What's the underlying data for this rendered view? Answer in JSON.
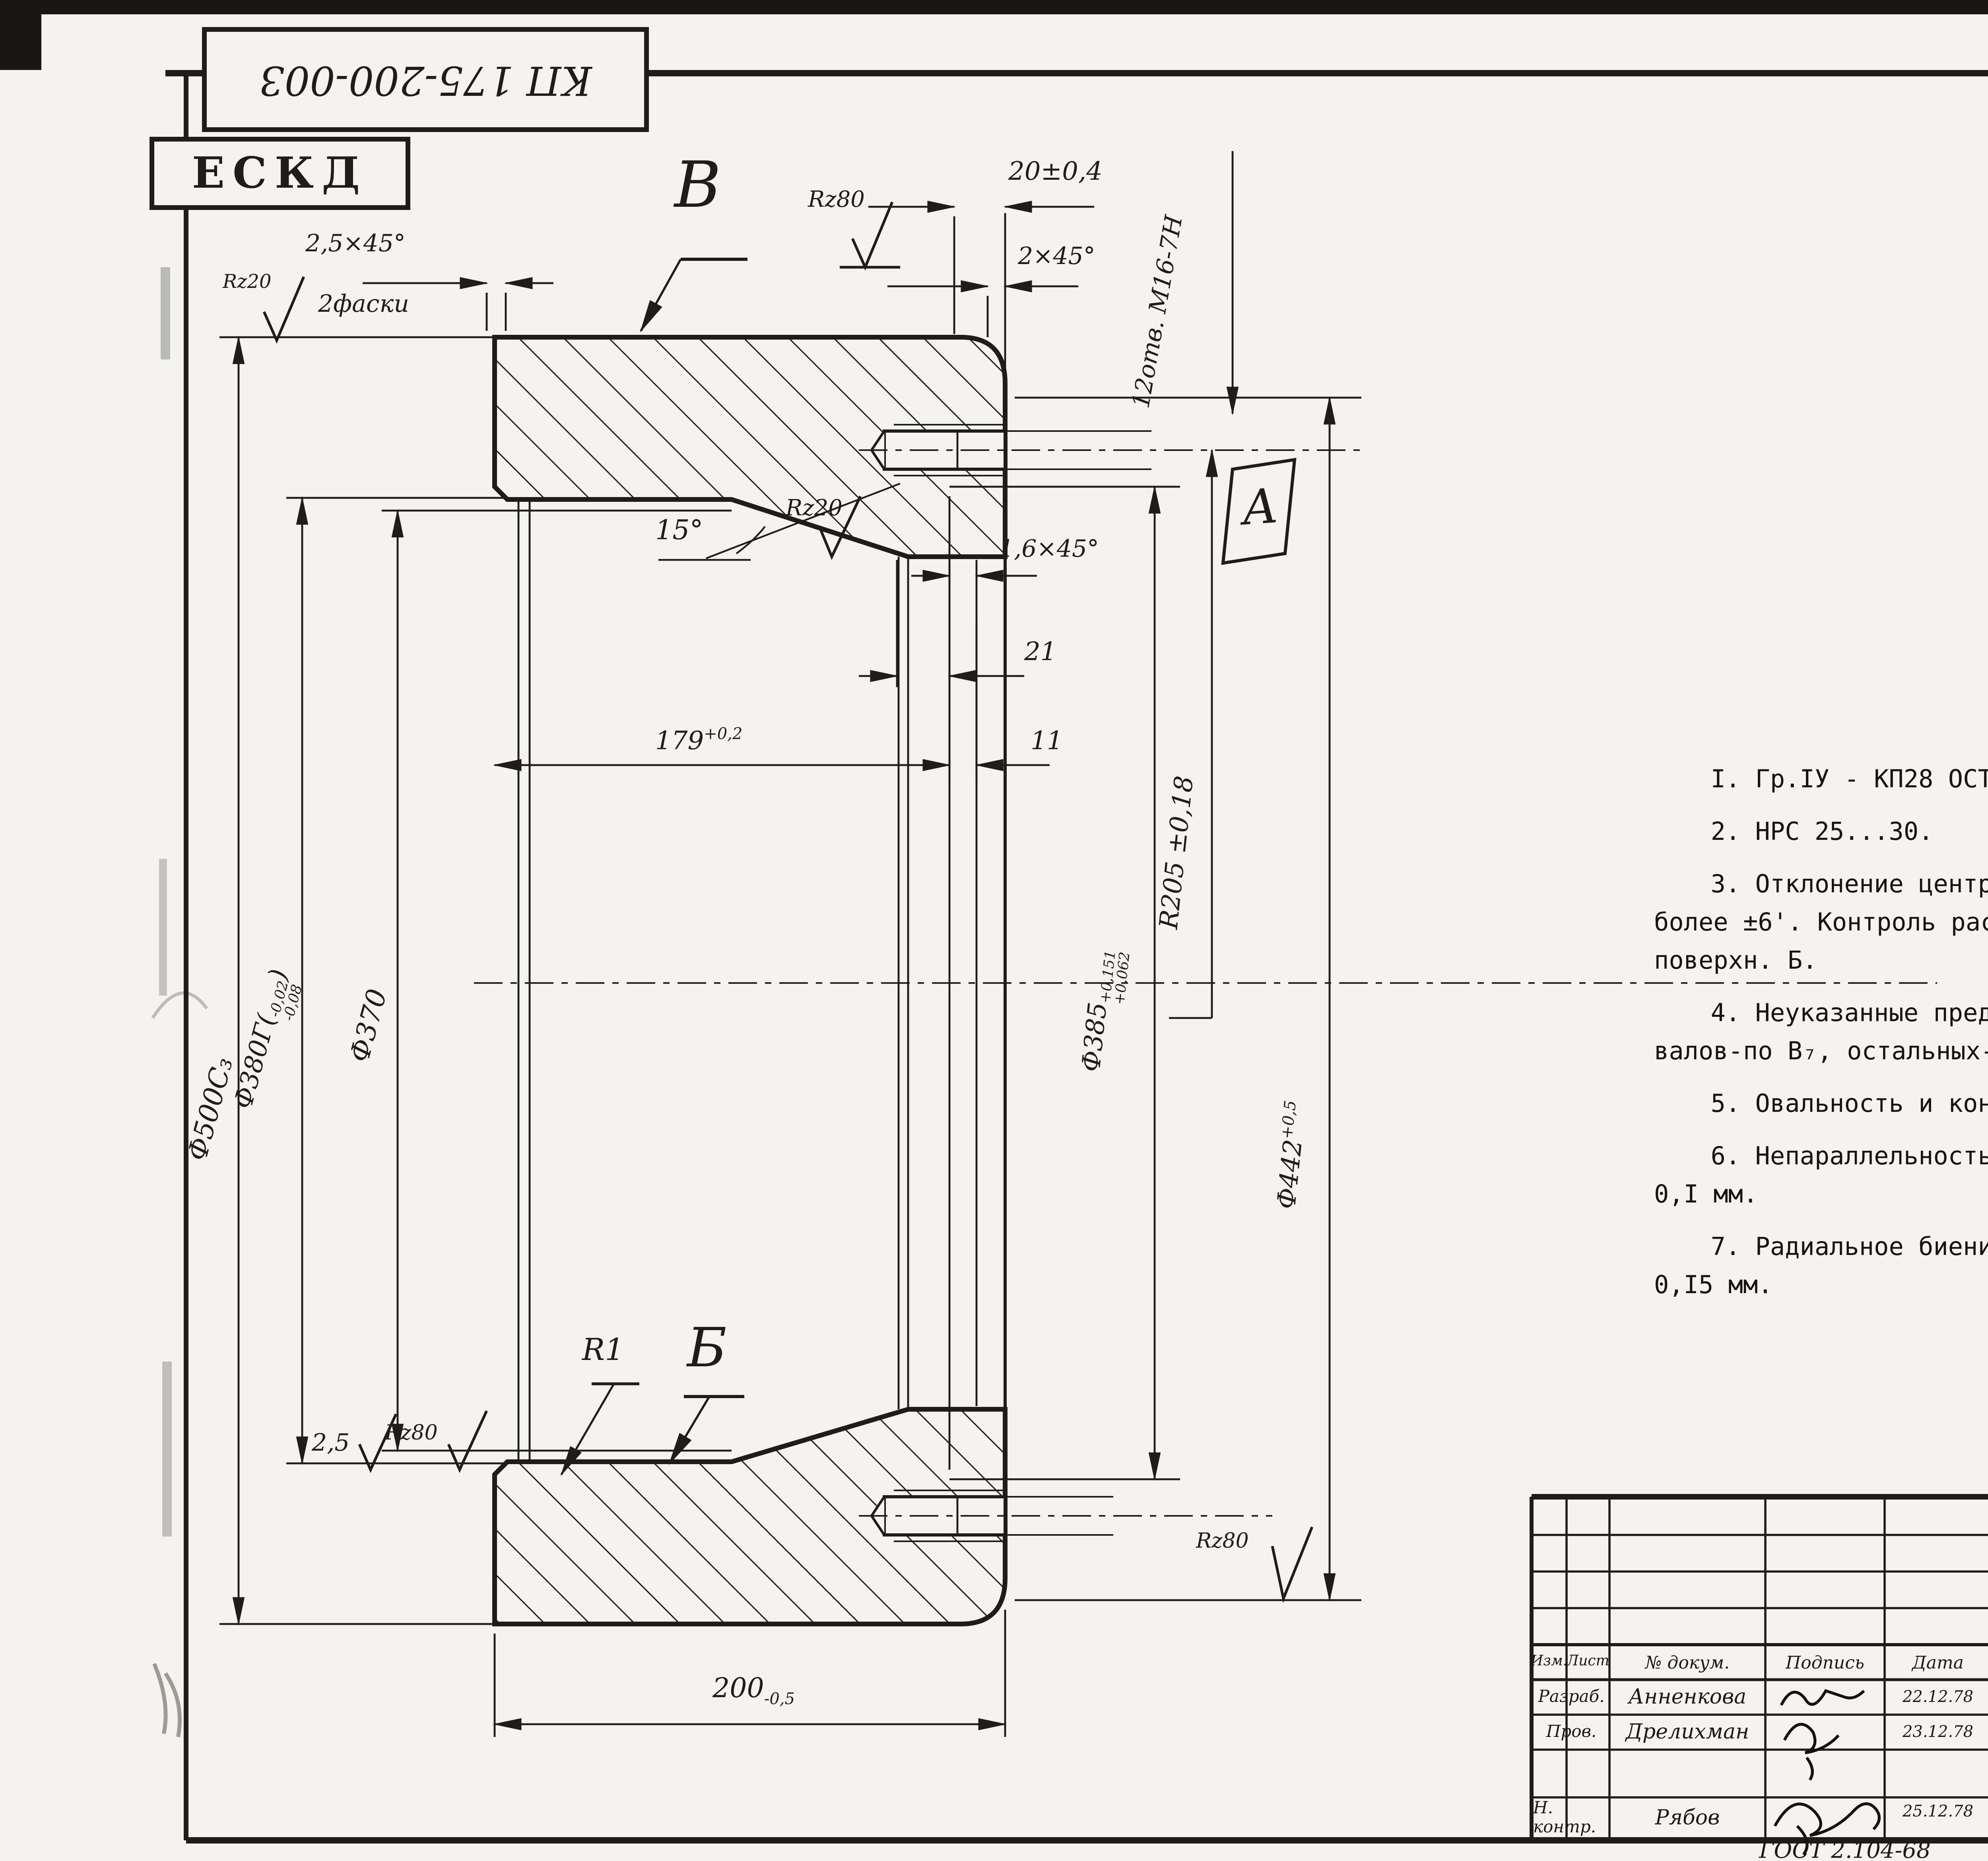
{
  "page": {
    "bg": "#f4f3ef",
    "ink": "#1f1d1a"
  },
  "corner_stamps": {
    "doc_number_mirrored": "КП 175-200-003",
    "eskd": "ЕСКД",
    "top_right_faint": "Формат 2"
  },
  "surface_finish": {
    "general_mark": "Rz40",
    "general_suffix": "(√)"
  },
  "view_labels": {
    "top_face": "В",
    "base_face": "Б",
    "hole_view": "А",
    "fillet": "R1"
  },
  "dims": {
    "width_top": "20±0,4",
    "chamfer_2": "2×45°",
    "rz80_top": "Rz80",
    "holes_note": "12отв. М16-7Н",
    "chamfer_25": "2,5×45°",
    "chamfer_25_sub": "2фаски",
    "rz20_left": "Rz20",
    "angle_15": "15°",
    "rz20_mid": "Rz20",
    "chamfer_16": "1,6×45°",
    "dim_21": "21",
    "dim_11": "11",
    "dim_179": {
      "value": "179",
      "tol": "+0,2"
    },
    "d500": "Ф500С₃",
    "d380": {
      "value": "Ф380Г",
      "tol_top": "-0,02",
      "tol_bot": "-0,08"
    },
    "d370": "Ф370",
    "r205": "R205 ±0,18",
    "d385": {
      "value": "Ф385",
      "tol_top": "+0,151",
      "tol_bot": "+0,062"
    },
    "d442": {
      "value": "Ф442",
      "tol": "+0,5"
    },
    "dim_25": "2,5",
    "rz80_bottom_left": "Rz80",
    "dim_200": {
      "value": "200",
      "tol": "-0,5"
    },
    "rz80_bottom_right": "Rz80"
  },
  "notes": {
    "lines": [
      "I. Гр.IУ - КП28 ОСТ 5.9I25-73.",
      "2. НРС 25...30.",
      "3. Отклонение центрального угла между осями двух любых отв.А не более ±6'. Контроль расположения центров отв. А относит. базовой поверхн. Б.",
      "4. Неуказанные предельные отклонения размеров: отверстий- по А₇, валов-по В₇, остальных-по СМ₈.",
      "5. Овальность и конусообр. поверхн. Б не более 0,03 мм.",
      "6. Непараллельность поверхн. В относит оси поверхн. Б не более 0,I мм.",
      "7. Радиальное биение поверхн. В относит. оси поверхн. Б не более 0,I5 мм."
    ]
  },
  "title_block": {
    "doc_number": "КП175-200-003",
    "part_name": "Каток.",
    "material": "Сталь 45-а ГОСТ 1050 - 74",
    "org_line1": "Балтийское",
    "org_line2": "ЦПКБ",
    "lit_label": "Лит.",
    "mass_label": "Масса",
    "scale_label": "Масшт.",
    "lit_value": "И",
    "mass_value": "126",
    "scale_value": "1:2,5",
    "sheet_label": "Лист",
    "sheets_label": "Листов 1",
    "columns": {
      "izm": "Изм.",
      "list": "Лист",
      "doc": "№ докум.",
      "sign": "Подпись",
      "date": "Дата"
    },
    "rows": [
      {
        "role": "Разраб.",
        "name": "Анненкова",
        "date": "22.12.78"
      },
      {
        "role": "Пров.",
        "name": "Дрелихман",
        "date": "23.12.78"
      },
      {
        "role": "Н. контр.",
        "name": "Рябов",
        "date": "25.12.78"
      }
    ],
    "gost_ref": "ГОСТ 2.104-68",
    "format_note": "Формат 12"
  }
}
